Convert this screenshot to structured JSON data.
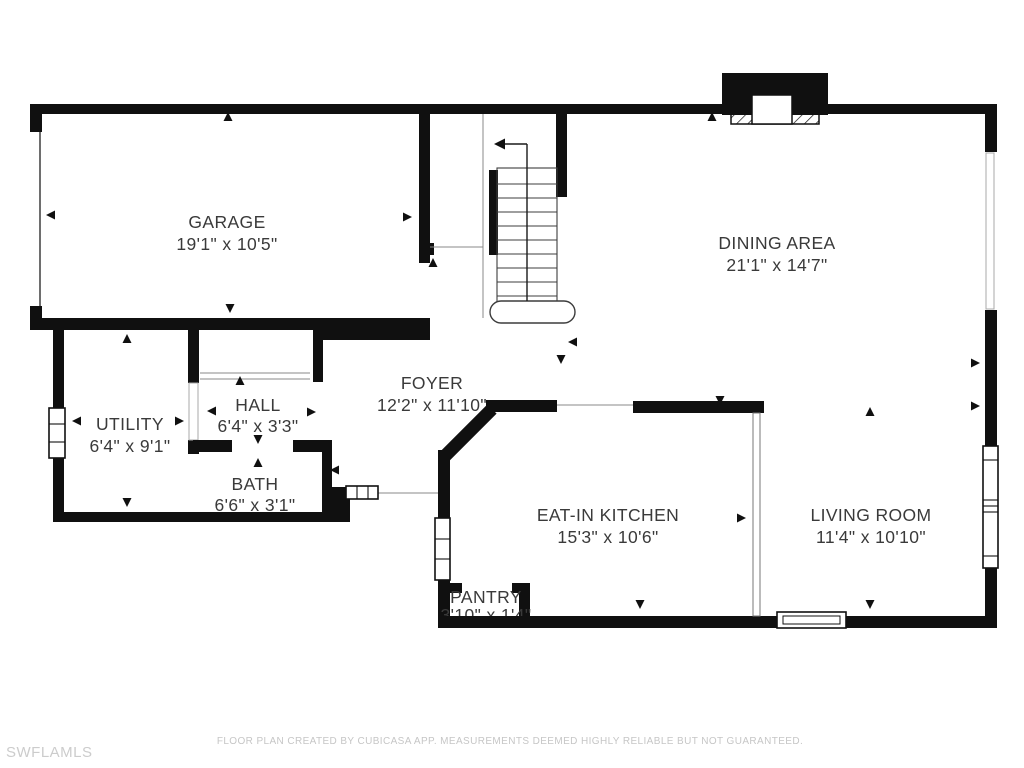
{
  "meta": {
    "background": "#ffffff",
    "wall_color": "#101010",
    "label_color": "#3a3a3a",
    "watermark_color": "#cccccc"
  },
  "rooms": {
    "garage": {
      "name": "GARAGE",
      "dims": "19'1\" x 10'5\""
    },
    "dining": {
      "name": "DINING AREA",
      "dims": "21'1\" x 14'7\""
    },
    "utility": {
      "name": "UTILITY",
      "dims": "6'4\" x 9'1\""
    },
    "hall": {
      "name": "HALL",
      "dims": "6'4\" x 3'3\""
    },
    "bath": {
      "name": "BATH",
      "dims": "6'6\" x 3'1\""
    },
    "foyer": {
      "name": "FOYER",
      "dims": "12'2\" x 11'10\""
    },
    "kitchen": {
      "name": "EAT-IN KITCHEN",
      "dims": "15'3\" x 10'6\""
    },
    "living": {
      "name": "LIVING ROOM",
      "dims": "11'4\" x 10'10\""
    },
    "pantry": {
      "name": "PANTRY",
      "dims": "3'10\" x 1'4\""
    }
  },
  "footer": {
    "disclaimer": "FLOOR PLAN CREATED BY CUBICASA APP. MEASUREMENTS DEEMED HIGHLY RELIABLE BUT NOT GUARANTEED."
  },
  "watermark": "SWFLAMLS"
}
